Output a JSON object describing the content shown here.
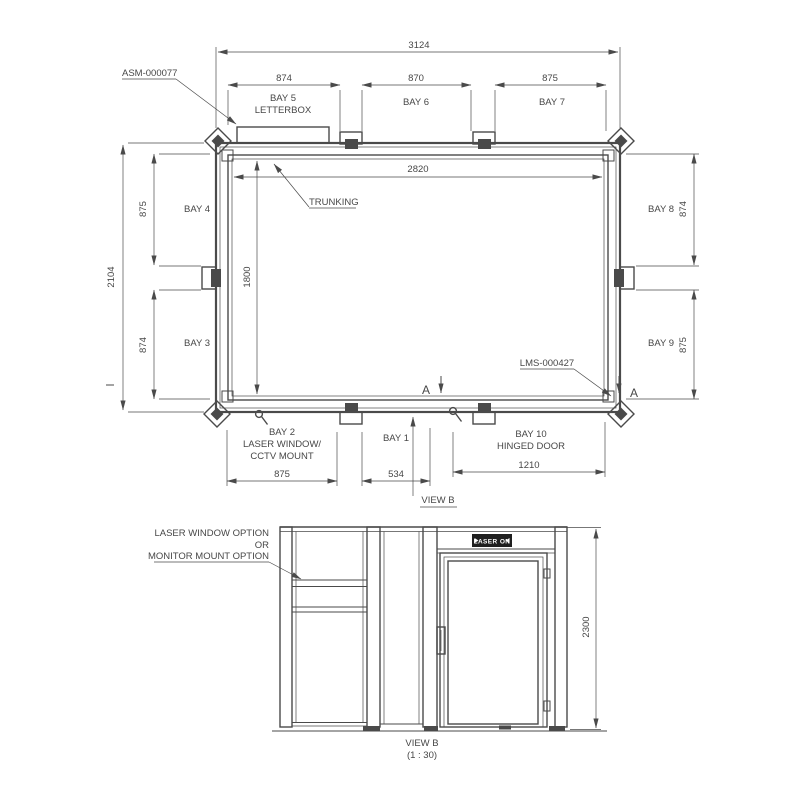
{
  "colors": {
    "background": "#ffffff",
    "line": "#4a4a4a",
    "text": "#474747",
    "sign_bg": "#1f1f1f",
    "sign_text": "#ffffff"
  },
  "plan": {
    "ref_assembly": "ASM-000077",
    "ref_module": "LMS-000427",
    "trunking_label": "TRUNKING",
    "section_marker": "A",
    "view_marker": "VIEW B",
    "dim_overall_width": "3124",
    "dim_overall_height": "2104",
    "dim_interior_width": "2820",
    "dim_interior_height": "1800",
    "top": {
      "bay5": "BAY 5",
      "bay5_sub": "LETTERBOX",
      "dim5": "874",
      "bay6": "BAY 6",
      "dim6": "870",
      "bay7": "BAY 7",
      "dim7": "875"
    },
    "left": {
      "bay4": "BAY 4",
      "dim4": "875",
      "bay3": "BAY 3",
      "dim3": "874"
    },
    "right": {
      "bay8": "BAY 8",
      "dim8": "874",
      "bay9": "BAY 9",
      "dim9": "875"
    },
    "bottom": {
      "bay2": "BAY 2",
      "bay2_sub1": "LASER WINDOW/",
      "bay2_sub2": "CCTV MOUNT",
      "dim2": "875",
      "bay1": "BAY 1",
      "dim1": "534",
      "bay10": "BAY 10",
      "bay10_sub": "HINGED DOOR",
      "dim10": "1210"
    }
  },
  "elevation": {
    "option_line1": "LASER WINDOW OPTION",
    "option_line2": "OR",
    "option_line3": "MONITOR MOUNT OPTION",
    "sign_label": "LASER ON",
    "dim_height": "2300",
    "view_label": "VIEW B",
    "view_scale": "(1 : 30)"
  }
}
